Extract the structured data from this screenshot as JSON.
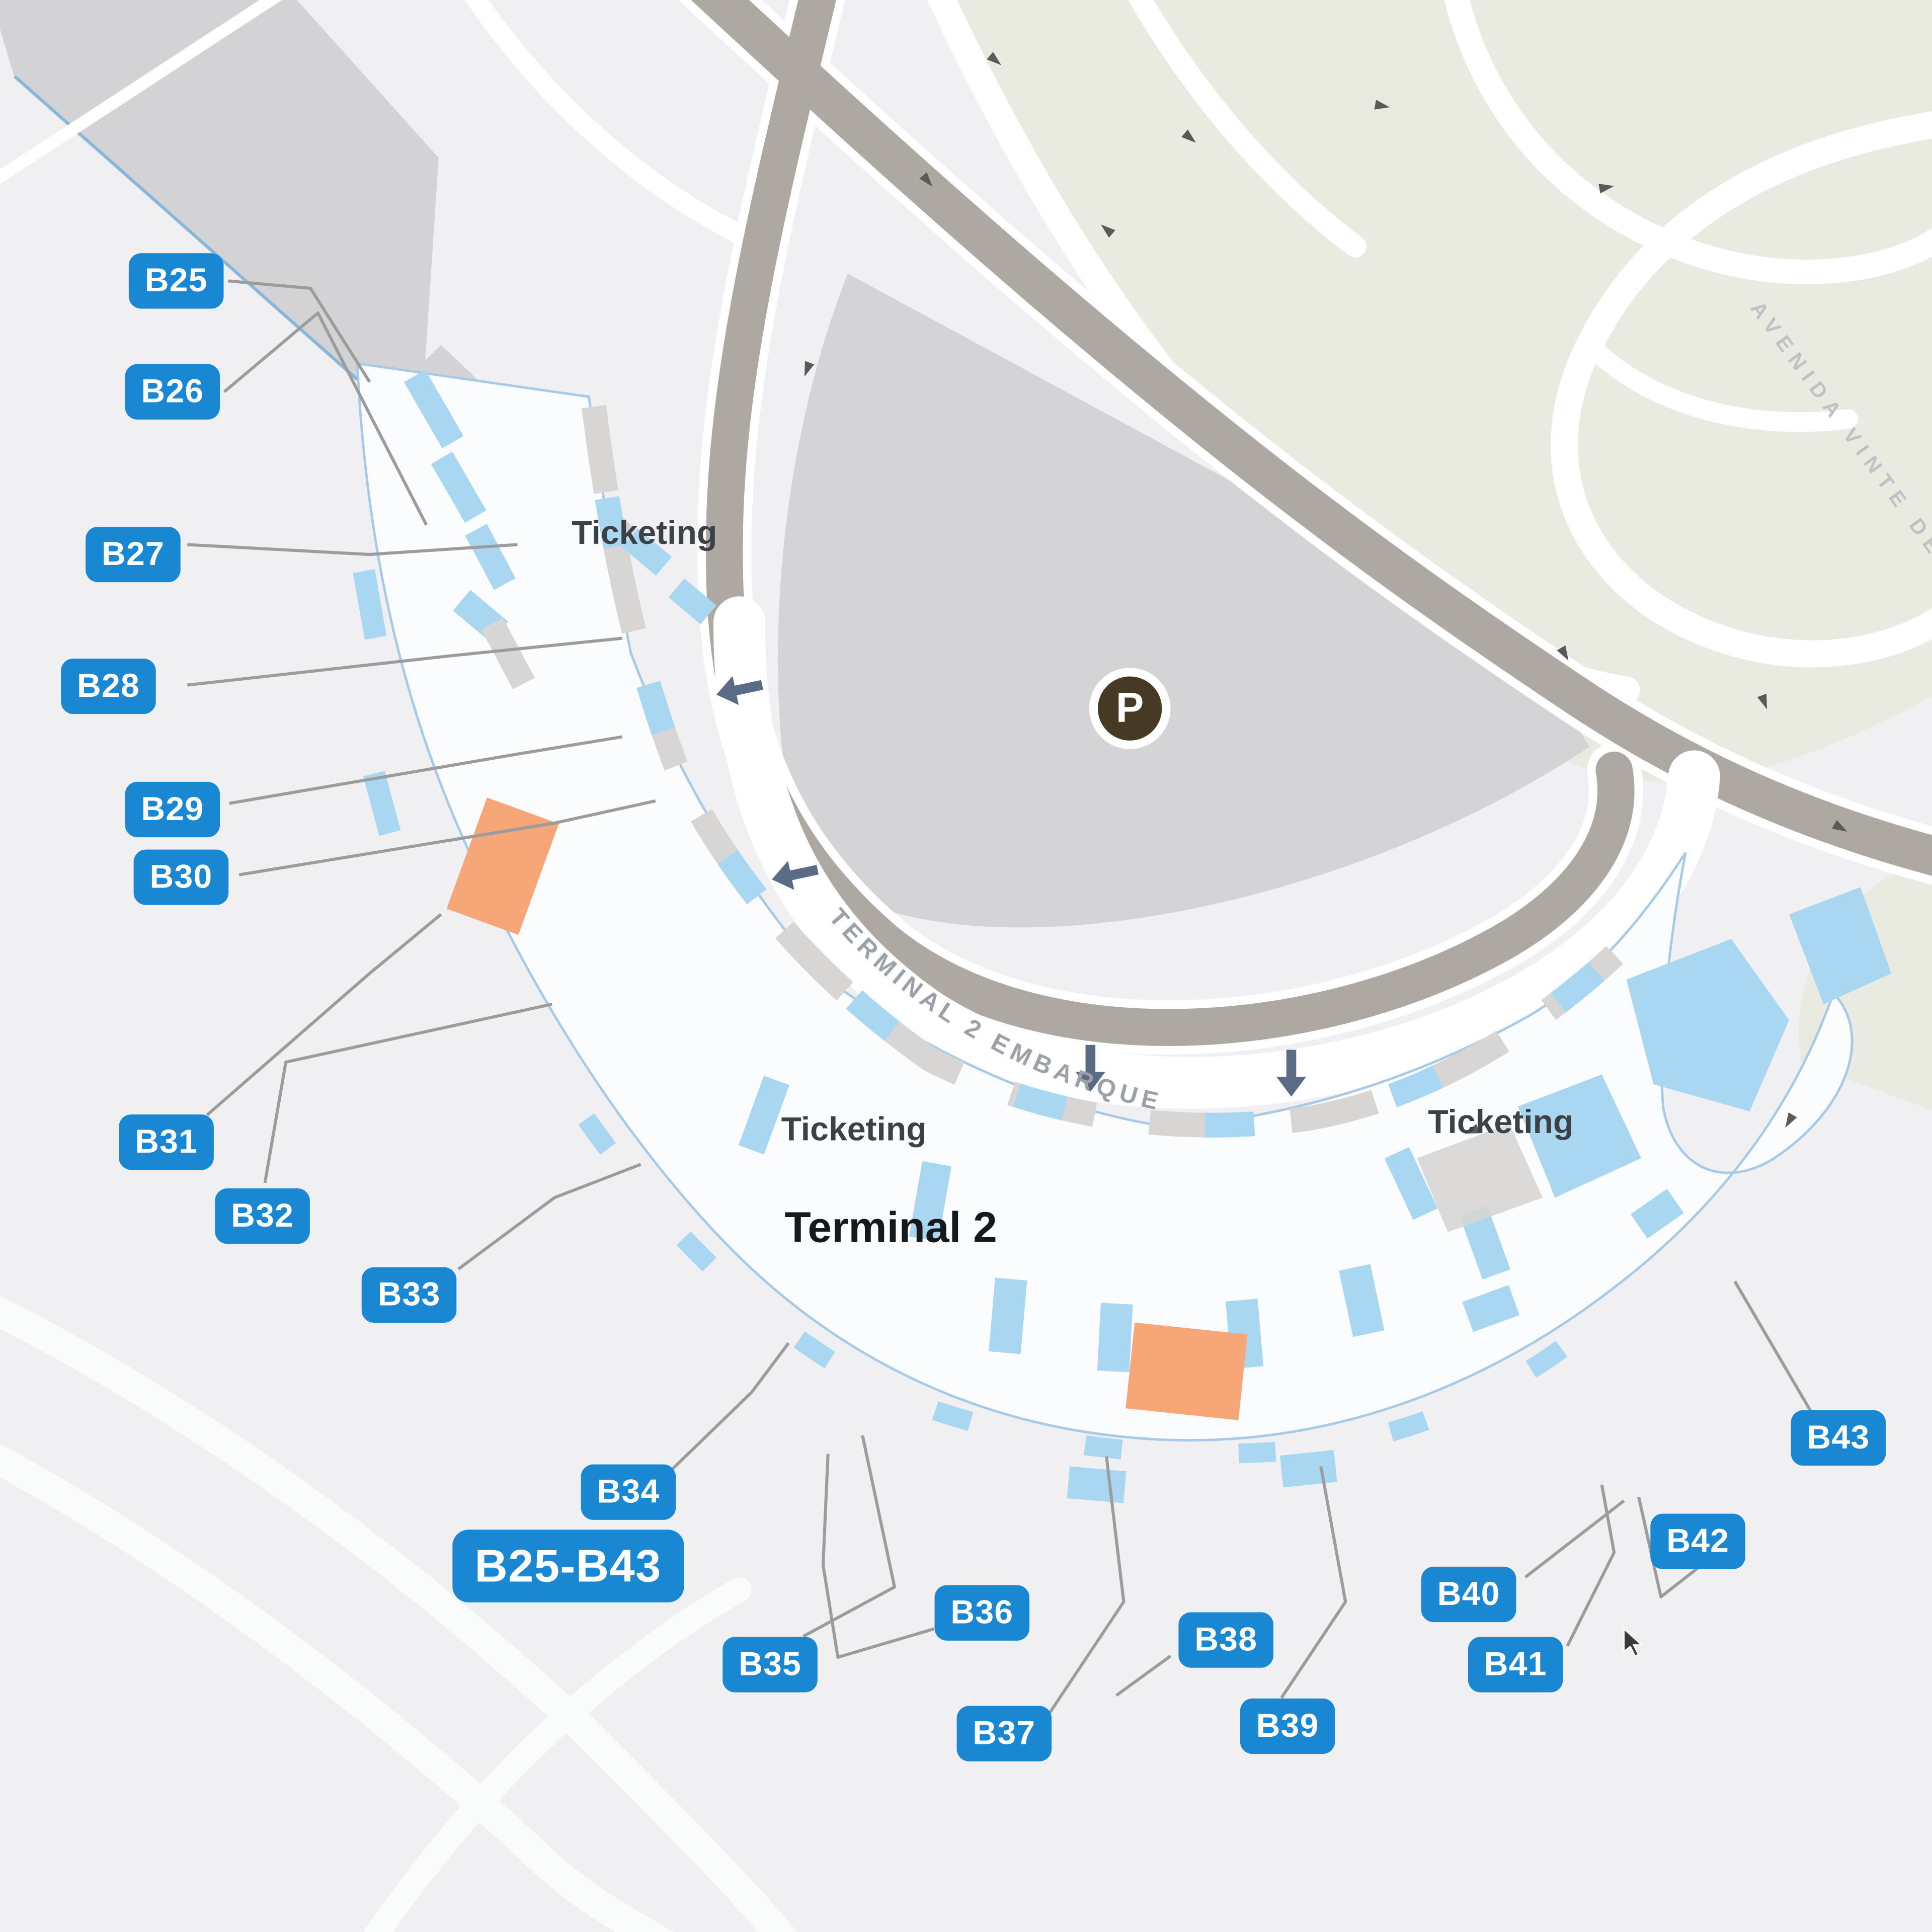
{
  "map": {
    "terminal_label": "Terminal 2",
    "gate_range_label": "B25-B43",
    "ticketing_labels": [
      "Ticketing",
      "Ticketing",
      "Ticketing"
    ],
    "road_labels": {
      "embarque": "TERMINAL 2 EMBARQUE",
      "avenida": "AVENIDA VINTE DE"
    },
    "parking": {
      "symbol": "P"
    },
    "gates": [
      {
        "label": "B25"
      },
      {
        "label": "B26"
      },
      {
        "label": "B27"
      },
      {
        "label": "B28"
      },
      {
        "label": "B29"
      },
      {
        "label": "B30"
      },
      {
        "label": "B31"
      },
      {
        "label": "B32"
      },
      {
        "label": "B33"
      },
      {
        "label": "B34"
      },
      {
        "label": "B35"
      },
      {
        "label": "B36"
      },
      {
        "label": "B37"
      },
      {
        "label": "B38"
      },
      {
        "label": "B39"
      },
      {
        "label": "B40"
      },
      {
        "label": "B41"
      },
      {
        "label": "B42"
      },
      {
        "label": "B43"
      }
    ],
    "colors": {
      "background": "#F0F0F2",
      "pill_blue": "#1987D2",
      "gate_light_blue": "#A9D7F2",
      "highlight_orange": "#F7A678",
      "road_dark": "#ADA8A1",
      "parking_gray": "#D4D4D6",
      "terminal_outline_blue": "#A9CAE6",
      "green_infield": "#E9EAE0",
      "parking_icon_brown": "#473A24",
      "arrow_slate": "#5A6B85"
    }
  }
}
